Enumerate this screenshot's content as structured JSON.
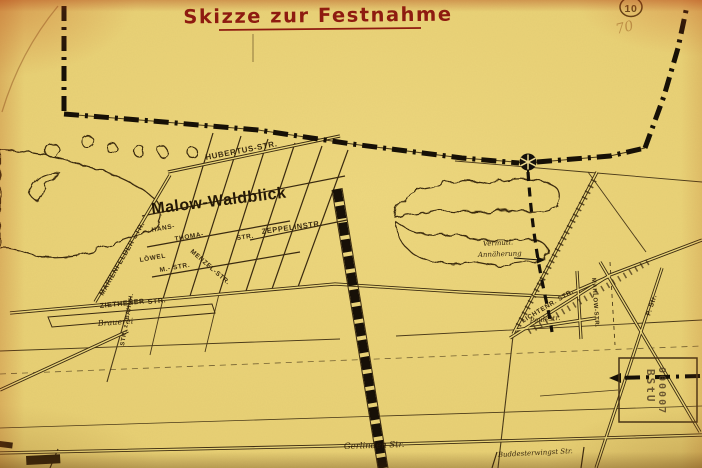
{
  "document": {
    "title": "Skizze zur Festnahme",
    "page_number_circled": "10",
    "pencil_note": "70"
  },
  "map": {
    "settlement": "Malow-Waldblick",
    "streets": {
      "hubertus": "HUBERTUS-STR.",
      "zeppelin": "ZEPPELINSTR.",
      "marienfelder": "MARIENFELDER STR.",
      "hans": "HANS-",
      "thoma": "THOMA-",
      "thoma_suffix": "STR.",
      "loewel": "LÖWEL",
      "m_str": "M.- STR.",
      "menzel": "MENZEL-STR.",
      "ziethener": "ZIETHENER",
      "ziethener_suffix": "STR.",
      "str_z_bahnhof": "STR. z. BAHNH.",
      "mahlow": "MAHLOW-STR.",
      "lichtenrader": "LICHTENR. STR.",
      "p_str": "P. Str.",
      "paule": "Paulestr.",
      "gerlinden": "Gerlinden Str.",
      "buddester": "Buddesterwingst Str."
    },
    "places": {
      "brauerei": "Brauerei"
    },
    "annotations": {
      "approach_line1": "Vermutl.",
      "approach_line2": "Annäherung"
    },
    "stamp": {
      "org": "BStU",
      "number": "000007"
    }
  },
  "colors": {
    "paper": "#e7cf74",
    "ink": "#3a2a10",
    "title_ink": "#8e1b10",
    "boundary": "#171008"
  }
}
